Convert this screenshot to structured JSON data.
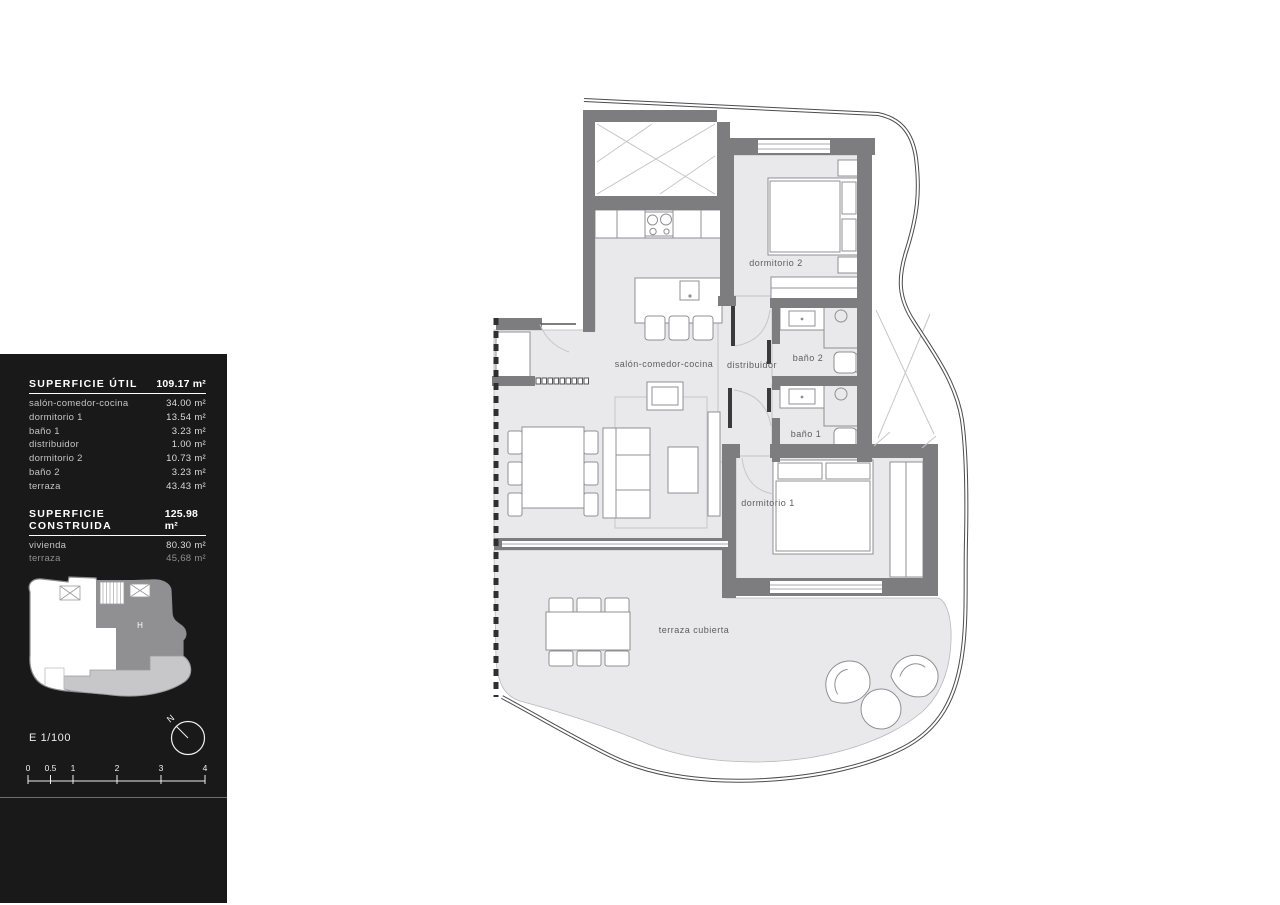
{
  "panel": {
    "superficie_util": {
      "title": "SUPERFICIE ÚTIL",
      "total": "109.17 m²",
      "rows": [
        {
          "label": "salón-comedor-cocina",
          "value": "34.00 m²"
        },
        {
          "label": "dormitorio 1",
          "value": "13.54 m²"
        },
        {
          "label": "baño 1",
          "value": "3.23 m²"
        },
        {
          "label": "distribuidor",
          "value": "1.00 m²"
        },
        {
          "label": "dormitorio 2",
          "value": "10.73 m²"
        },
        {
          "label": "baño 2",
          "value": "3.23 m²"
        },
        {
          "label": "terraza",
          "value": "43.43 m²"
        }
      ]
    },
    "superficie_construida": {
      "title": "SUPERFICIE CONSTRUIDA",
      "total": "125.98 m²",
      "rows": [
        {
          "label": "vivienda",
          "value": "80.30 m²"
        },
        {
          "label": "terraza",
          "value": "45,68 m²"
        }
      ]
    },
    "scale_label": "E 1/100",
    "north_label": "N",
    "locator_unit": "H",
    "scale_ticks": [
      "0",
      "0.5",
      "1",
      "2",
      "3",
      "4"
    ]
  },
  "plan": {
    "rooms": {
      "salon": "salón-comedor-cocina",
      "distribuidor": "distribuidor",
      "bano2": "baño 2",
      "bano1": "baño 1",
      "dormitorio2": "dormitorio 2",
      "dormitorio1": "dormitorio 1",
      "terraza": "terraza cubierta"
    }
  },
  "colors": {
    "panel_bg": "#191919",
    "wall": "#7d7d7f",
    "floor": "#e9e9eb",
    "locator_unit": "#909092",
    "locator_terrace": "#c7c7c9"
  }
}
